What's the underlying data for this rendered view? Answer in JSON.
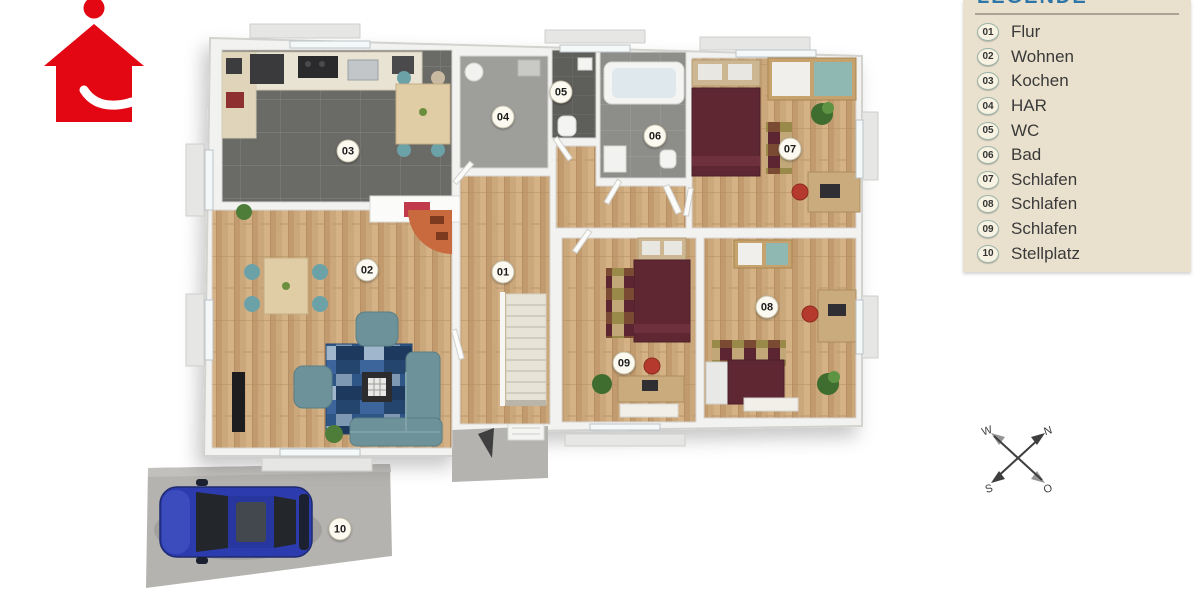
{
  "legend": {
    "title": "LEGENDE"
  },
  "rooms": [
    {
      "num": "01",
      "label": "Flur"
    },
    {
      "num": "02",
      "label": "Wohnen"
    },
    {
      "num": "03",
      "label": "Kochen"
    },
    {
      "num": "04",
      "label": "HAR"
    },
    {
      "num": "05",
      "label": "WC"
    },
    {
      "num": "06",
      "label": "Bad"
    },
    {
      "num": "07",
      "label": "Schlafen"
    },
    {
      "num": "08",
      "label": "Schlafen"
    },
    {
      "num": "09",
      "label": "Schlafen"
    },
    {
      "num": "10",
      "label": "Stellplatz"
    }
  ],
  "compass": {
    "north": "N",
    "east": "O",
    "south": "S",
    "west": "W"
  },
  "colors": {
    "brand_red": "#e30613",
    "legend_bg": "#e9e1ce",
    "legend_title_blue": "#2e76a8",
    "wood_floor": "#c9a478",
    "kitchen_tile": "#6a6a67",
    "wall_white": "#f2f2f1",
    "sofa_teal": "#6d929a",
    "bed_maroon": "#5e2732",
    "rug_blue": "#2e5687",
    "car_blue": "#2c3cae",
    "parking_gray": "#b5b3b0",
    "compass_ink": "#3e3e3e"
  }
}
